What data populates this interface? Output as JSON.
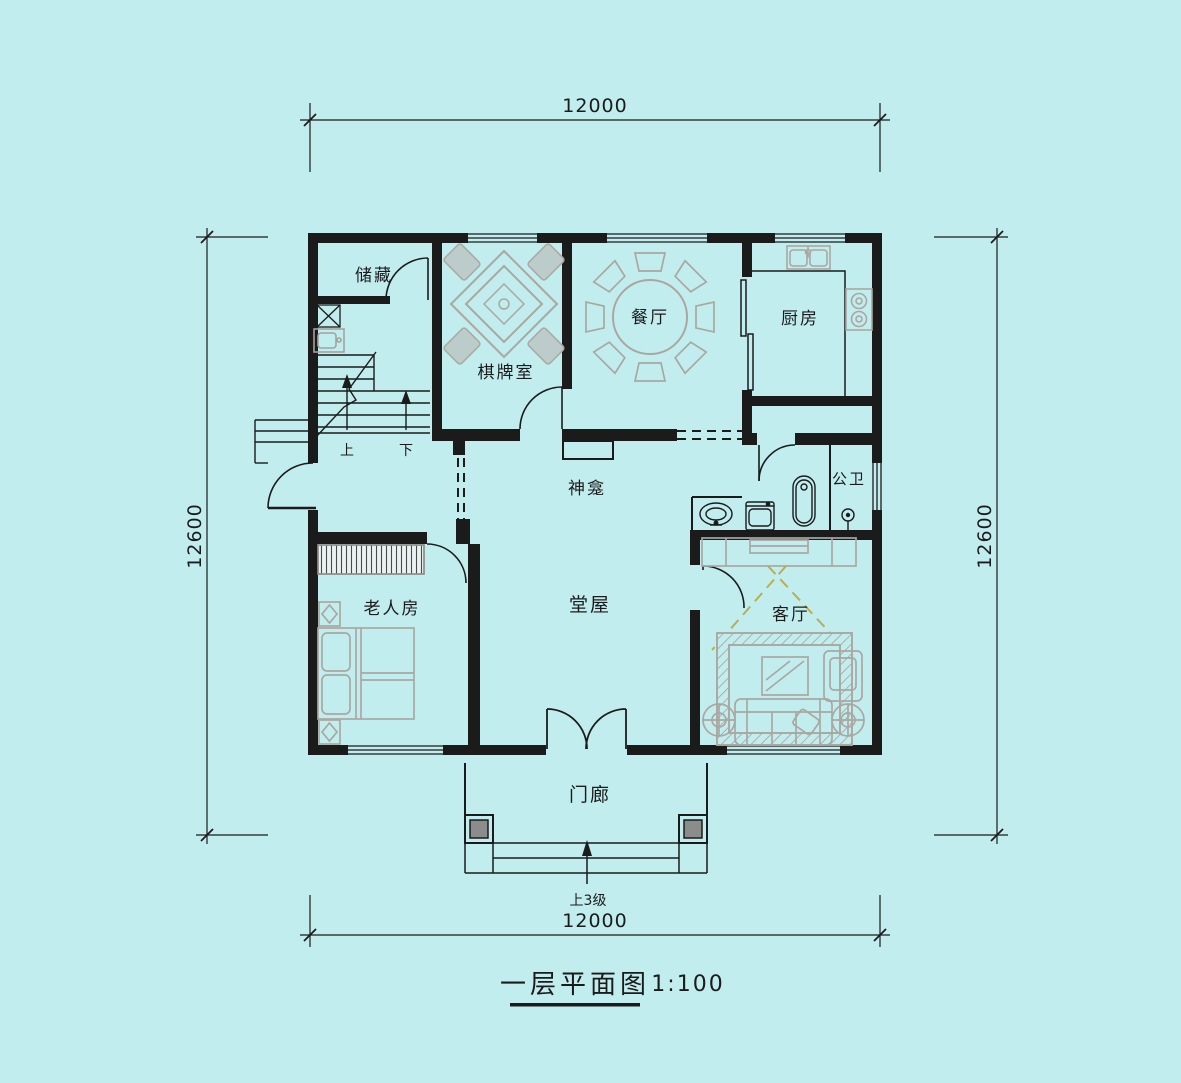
{
  "title": {
    "name": "一层平面图",
    "scale": "1:100"
  },
  "dimensions": {
    "top": "12000",
    "bottom": "12000",
    "left": "12600",
    "right": "12600"
  },
  "rooms": {
    "storage": "储藏",
    "chess_room": "棋牌室",
    "dining": "餐厅",
    "kitchen": "厨房",
    "shrine": "神龛",
    "hall": "堂屋",
    "bathroom": "公卫",
    "elder_room": "老人房",
    "living": "客厅",
    "porch": "门廊"
  },
  "stairs": {
    "up": "上",
    "down": "下"
  },
  "notes": {
    "entry_steps": "上3级"
  },
  "colors": {
    "background": "#c2edef",
    "wall": "#1b1b1b",
    "furniture": "#a5a29c",
    "tv_projection": "#b9ae4e",
    "column_fill": "#8c8c8c"
  }
}
